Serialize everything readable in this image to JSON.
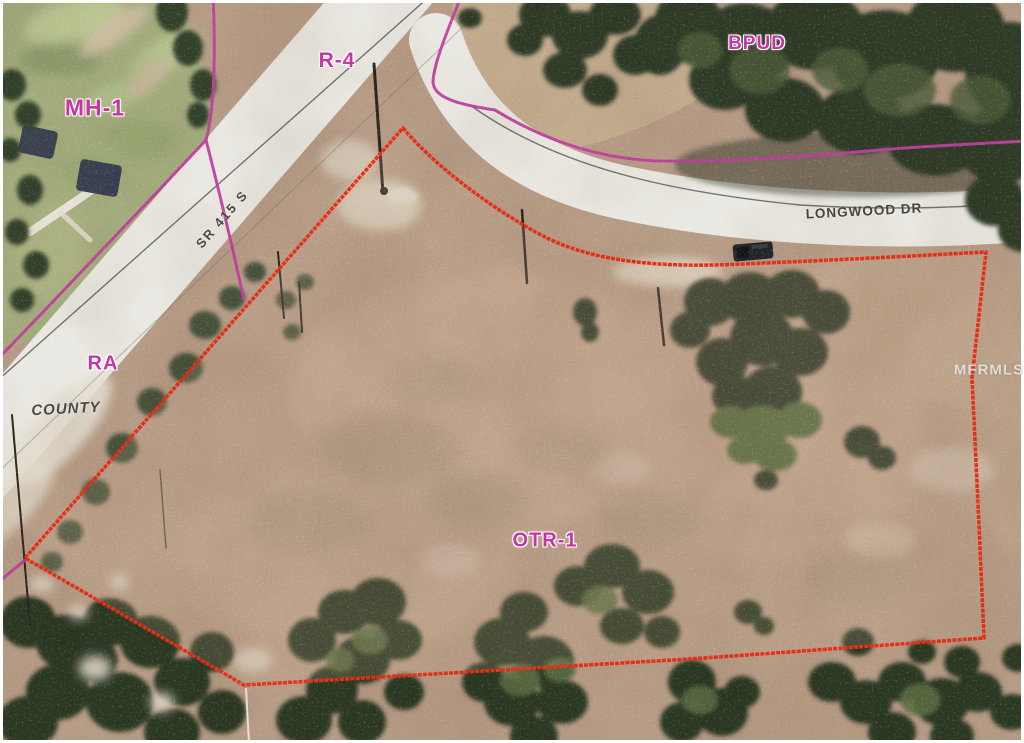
{
  "window": {
    "type": "aerial-zoning-parcel-map"
  },
  "labels": {
    "zoning": {
      "mh1": "MH-1",
      "r4": "R-4",
      "bpud": "BPUD",
      "ra": "RA",
      "otr1": "OTR-1"
    },
    "roads": {
      "sr415": "SR 415 S",
      "longwood": "LONGWOOD DR",
      "county": "COUNTY"
    },
    "watermark": "MFRMLS"
  },
  "colors": {
    "boundary-red": "#e92d16",
    "zoning-magenta": "#bf3f9f",
    "label-magenta": "#c437a2",
    "road-white": "#eae8e2",
    "dirt": "#b69b85",
    "forest-dark": "#2e3a26",
    "golf-green": "#a3ac7c",
    "road-text": "#45443e",
    "watermark-gray": "#eceae6"
  }
}
